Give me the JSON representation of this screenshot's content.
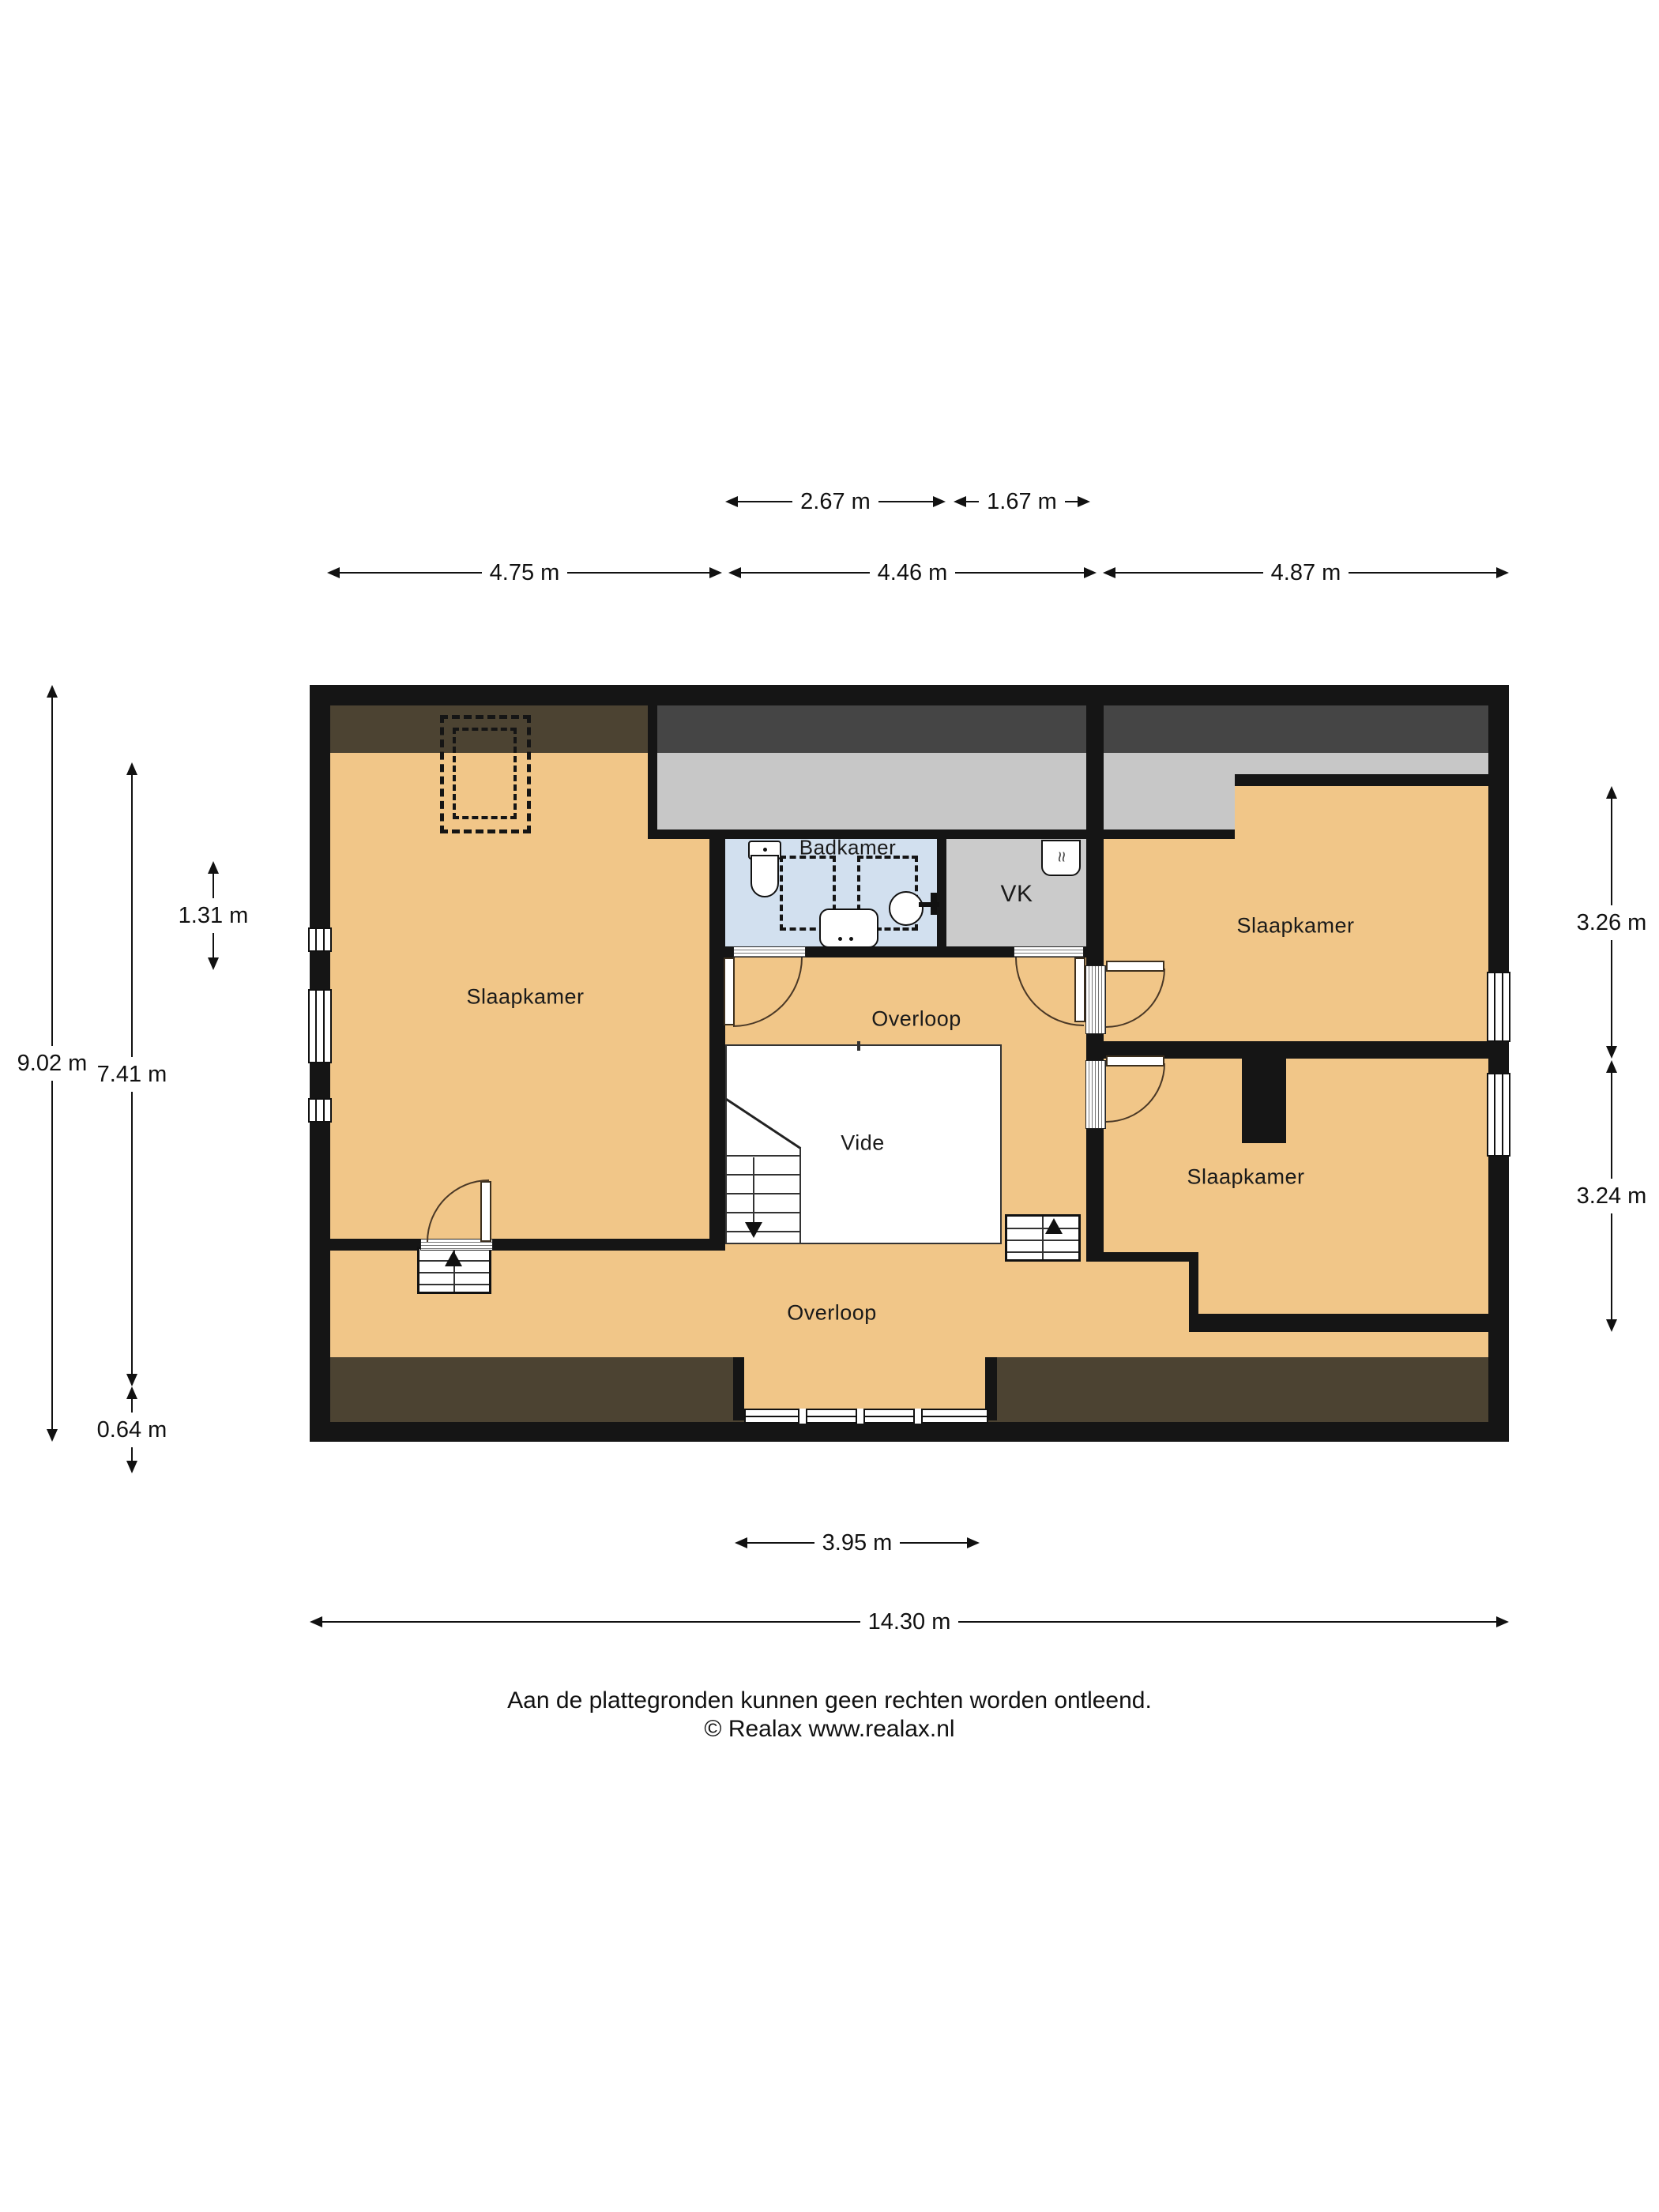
{
  "plan_type": "floorplan",
  "rooms": {
    "bedroom_left": {
      "label": "Slaapkamer"
    },
    "bedroom_right_top": {
      "label": "Slaapkamer"
    },
    "bedroom_right_bottom": {
      "label": "Slaapkamer"
    },
    "bathroom": {
      "label": "Badkamer"
    },
    "closet": {
      "label": "VK"
    },
    "landing_mid": {
      "label": "Overloop"
    },
    "landing_bottom": {
      "label": "Overloop"
    },
    "void": {
      "label": "Vide"
    }
  },
  "dimensions": {
    "top_row": [
      {
        "label": "2.67 m"
      },
      {
        "label": "1.67 m"
      }
    ],
    "upper_row": [
      {
        "label": "4.75 m"
      },
      {
        "label": "4.46 m"
      },
      {
        "label": "4.87 m"
      }
    ],
    "left": [
      {
        "label": "9.02 m"
      },
      {
        "label": "7.41 m"
      },
      {
        "label": "1.31 m"
      },
      {
        "label": "0.64 m"
      }
    ],
    "right": [
      {
        "label": "3.26 m"
      },
      {
        "label": "3.24 m"
      }
    ],
    "bottom": [
      {
        "label": "3.95 m"
      },
      {
        "label": "14.30 m"
      }
    ]
  },
  "footer": {
    "disclaimer": "Aan de plattegronden kunnen geen rechten worden ontleend.",
    "copyright": "© Realax www.realax.nl"
  },
  "icons": {
    "stairs_up_left": "arrow-up",
    "stairs_up_right": "arrow-up",
    "stairs_down_vide": "arrow-down",
    "closet_unit": "ventilation-icon",
    "bathroom_items": [
      "toilet-icon",
      "sink-icon",
      "basin-icon",
      "faucet-icon",
      "shower-dashed-zone"
    ]
  },
  "colors": {
    "wall": "#151515",
    "floor_tan": "#f1c688",
    "roof_band_brown": "#4c4332",
    "roof_band_dark_gray": "#454545",
    "roof_band_light_gray": "#c7c7c7",
    "bathroom_blue": "#d2e0ef",
    "closet_gray": "#cbcbcb",
    "void_white": "#ffffff"
  }
}
